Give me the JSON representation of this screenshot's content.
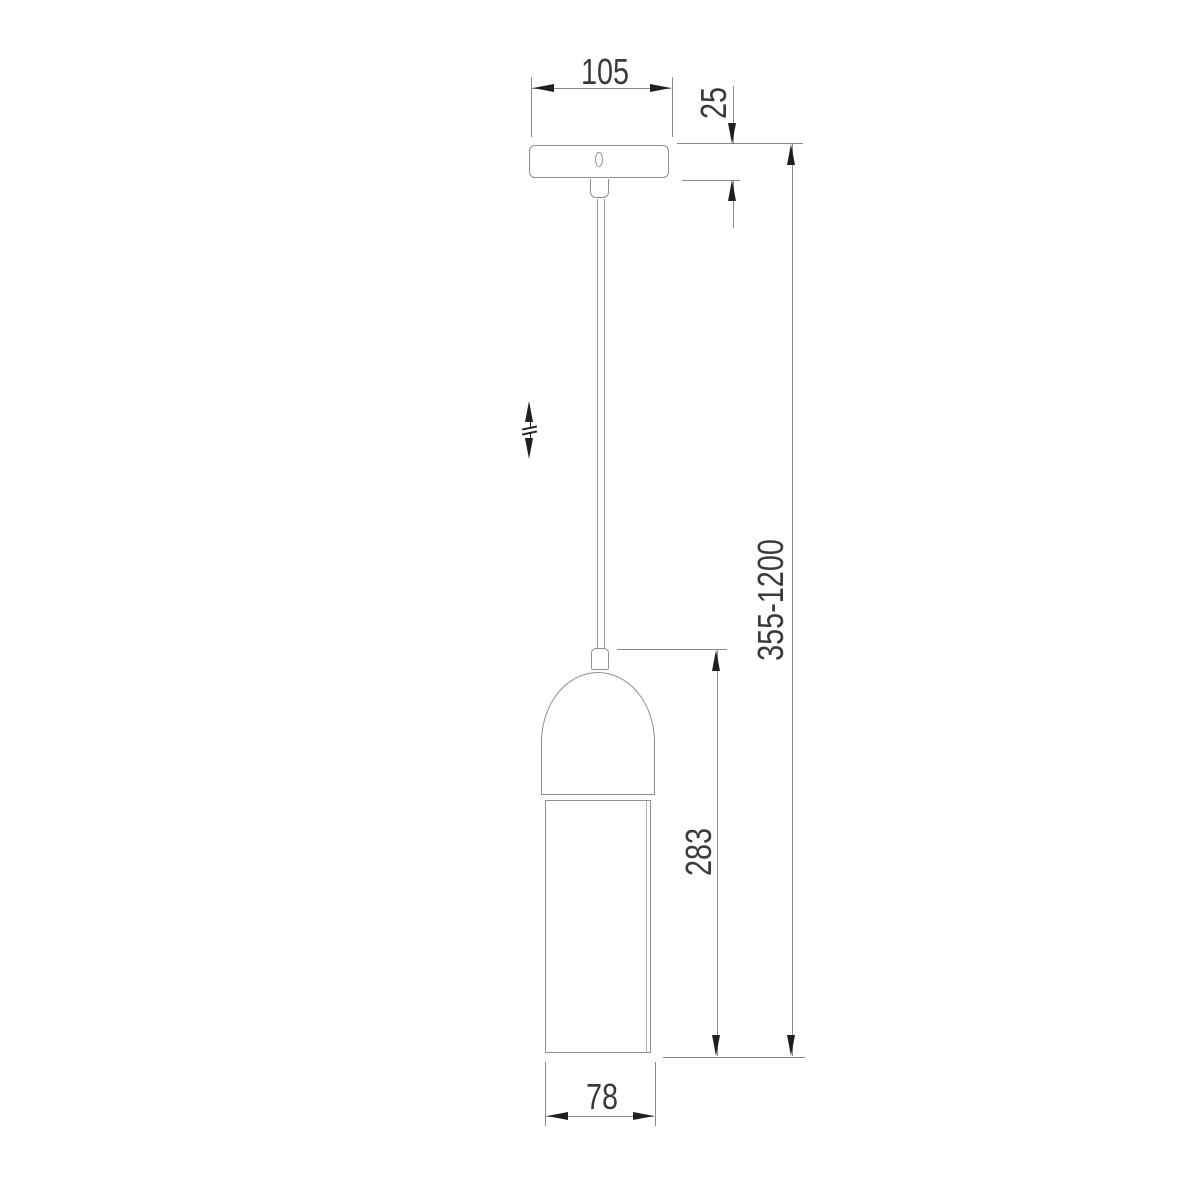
{
  "drawing": {
    "description": "pendant-lamp-dimension-drawing",
    "dimension_labels": {
      "canopy_width": "105",
      "canopy_height": "25",
      "overall_height_range": "355-1200",
      "shade_height": "283",
      "shade_width": "78"
    },
    "icons": {
      "height_adjust": "double-headed-arrow-with-break"
    },
    "colors": {
      "background": "#ffffff",
      "object_line": "#8f8f8f",
      "inner_line": "#b5b5b5",
      "cord_line": "#9a9a9a",
      "dimension_line": "#8a8a8a",
      "arrow": "#1f1f1f",
      "text": "#3a3a3a"
    }
  }
}
